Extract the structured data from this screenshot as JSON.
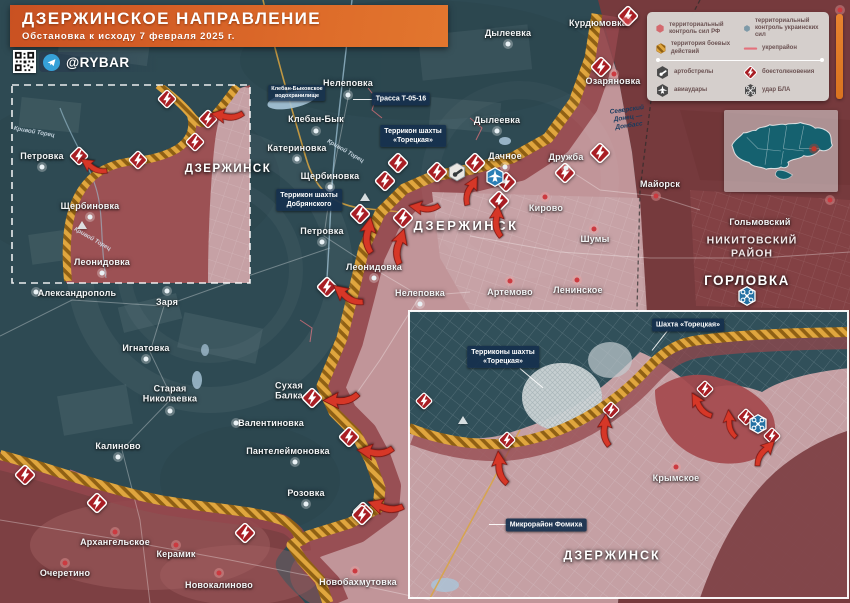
{
  "header": {
    "title": "ДЗЕРЖИНСКОЕ НАПРАВЛЕНИЕ",
    "subtitle": "Обстановка к исходу 7 февраля 2025 г.",
    "channel": "@RYBAR"
  },
  "legend": {
    "items": [
      {
        "icon": "rf-control",
        "label": "территориальный контроль сил РФ"
      },
      {
        "icon": "ukr-control",
        "label": "территориальный контроль украинских сил"
      },
      {
        "icon": "combat-zone",
        "label": "территория боевых действий"
      },
      {
        "icon": "fortified-line",
        "label": "укрепрайон"
      },
      {
        "icon": "artillery",
        "label": "артобстрелы"
      },
      {
        "icon": "clash",
        "label": "боестолкновения"
      },
      {
        "icon": "airstrike",
        "label": "авиаудары"
      },
      {
        "icon": "uav-strike",
        "label": "удар БЛА"
      }
    ]
  },
  "colors": {
    "rf_control": "#763a3d",
    "ukr_control": "#2e4a53",
    "combat_zone": "#e0a63e",
    "fortified_line": "#e4717b",
    "clash": "#a81e24",
    "banner_accent": "#d96428",
    "ukr_icon_blue": "#2b7fb5"
  },
  "map": {
    "town_labels": [
      {
        "t": "Нелеповка",
        "x": 348,
        "y": 83
      },
      {
        "t": "Клебан-Бык",
        "x": 316,
        "y": 119
      },
      {
        "t": "Катериновка",
        "x": 297,
        "y": 148
      },
      {
        "t": "Щербиновка",
        "x": 330,
        "y": 176
      },
      {
        "t": "Петровка",
        "x": 322,
        "y": 231
      },
      {
        "t": "Леонидовка",
        "x": 374,
        "y": 267
      },
      {
        "t": "Нелеповка",
        "x": 420,
        "y": 293
      },
      {
        "t": "Александрополь",
        "x": 77,
        "y": 293
      },
      {
        "t": "Заря",
        "x": 167,
        "y": 302
      },
      {
        "t": "Игнатовка",
        "x": 146,
        "y": 348
      },
      {
        "t": "Старая\nНиколаевка",
        "x": 170,
        "y": 394
      },
      {
        "t": "Калиново",
        "x": 118,
        "y": 446
      },
      {
        "t": "Сухая\nБалка",
        "x": 289,
        "y": 391
      },
      {
        "t": "Валентиновка",
        "x": 271,
        "y": 423
      },
      {
        "t": "Пантелеймоновка",
        "x": 288,
        "y": 451
      },
      {
        "t": "Розовка",
        "x": 306,
        "y": 493
      },
      {
        "t": "Архангельское",
        "x": 115,
        "y": 542
      },
      {
        "t": "Керамик",
        "x": 176,
        "y": 554
      },
      {
        "t": "Очеретино",
        "x": 65,
        "y": 573
      },
      {
        "t": "Новокалиново",
        "x": 219,
        "y": 585
      },
      {
        "t": "Новобахмутовка",
        "x": 358,
        "y": 582
      },
      {
        "t": "Дылеевка",
        "x": 508,
        "y": 33
      },
      {
        "t": "Курдюмовка",
        "x": 598,
        "y": 23
      },
      {
        "t": "Озаряновка",
        "x": 613,
        "y": 81
      },
      {
        "t": "Дылеевка",
        "x": 497,
        "y": 120
      },
      {
        "t": "Дачное",
        "x": 505,
        "y": 156
      },
      {
        "t": "Дружба",
        "x": 566,
        "y": 157
      },
      {
        "t": "Кирово",
        "x": 546,
        "y": 208
      },
      {
        "t": "Шумы",
        "x": 595,
        "y": 239
      },
      {
        "t": "Артемово",
        "x": 510,
        "y": 292
      },
      {
        "t": "Ленинское",
        "x": 578,
        "y": 290
      },
      {
        "t": "Майорск",
        "x": 660,
        "y": 184
      },
      {
        "t": "Гольмовский",
        "x": 760,
        "y": 222
      },
      {
        "t": "Крымское",
        "x": 676,
        "y": 478
      },
      {
        "t": "Петровка",
        "x": 42,
        "y": 156
      },
      {
        "t": "Щербиновка",
        "x": 90,
        "y": 206
      },
      {
        "t": "Леонидовка",
        "x": 102,
        "y": 262
      }
    ],
    "area_labels": [
      {
        "t": "ДЗЕРЖИНСК",
        "x": 466,
        "y": 226,
        "fs": 13,
        "ls": 2.5
      },
      {
        "t": "ДЗЕРЖИНСК",
        "x": 228,
        "y": 170,
        "fs": 11.5,
        "ls": 1.5
      },
      {
        "t": "ДЗЕРЖИНСК",
        "x": 612,
        "y": 556,
        "fs": 12.5,
        "ls": 2
      },
      {
        "t": "ГОРЛОВКА",
        "x": 747,
        "y": 281,
        "fs": 13.5,
        "ls": 1.5
      },
      {
        "t": "НИКИТОВСКИЙ\nРАЙОН",
        "x": 752,
        "y": 247,
        "fs": 10.5,
        "ls": 1,
        "op": 0.88
      }
    ],
    "callouts": [
      {
        "t": "Трасса Т-05-16",
        "x": 401,
        "y": 99,
        "leader": {
          "x": 353,
          "y": 99,
          "len": 26,
          "ang": 0
        }
      },
      {
        "t": "Террикон шахты\n«Торецкая»",
        "x": 413,
        "y": 136
      },
      {
        "t": "Террикон шахты\nДобрянского",
        "x": 309,
        "y": 200
      },
      {
        "t": "Клебан-Быковское\nводохранилище",
        "x": 297,
        "y": 93,
        "small": true
      },
      {
        "t": "Шахта «Торецкая»",
        "x": 688,
        "y": 325,
        "leader": {
          "x": 652,
          "y": 350,
          "len": 26,
          "ang": -52
        }
      },
      {
        "t": "Терриконы шахты\n«Торецкая»",
        "x": 503,
        "y": 357,
        "leader": {
          "x": 520,
          "y": 368,
          "len": 30,
          "ang": 40
        }
      },
      {
        "t": "Микрорайон Фомиха",
        "x": 546,
        "y": 525,
        "leader": {
          "x": 489,
          "y": 524,
          "len": 20,
          "ang": 0
        }
      }
    ],
    "river_labels": [
      {
        "t": "Кривой Торец",
        "x": 345,
        "y": 152,
        "ang": 30
      },
      {
        "t": "Кривой Торец",
        "x": 92,
        "y": 240,
        "ang": 30
      },
      {
        "t": "Кривой Торец",
        "x": 34,
        "y": 133,
        "ang": 10
      },
      {
        "t": "Северский\nДонец —\nДонбасс",
        "x": 628,
        "y": 118,
        "ang": -8,
        "cls": "canal"
      }
    ],
    "clash_main": [
      [
        601,
        67
      ],
      [
        628,
        16
      ],
      [
        600,
        153
      ],
      [
        565,
        173
      ],
      [
        506,
        182
      ],
      [
        475,
        163
      ],
      [
        499,
        201
      ],
      [
        437,
        172
      ],
      [
        398,
        163
      ],
      [
        385,
        181
      ],
      [
        403,
        218
      ],
      [
        360,
        214
      ],
      [
        327,
        287
      ],
      [
        312,
        398
      ],
      [
        349,
        437
      ],
      [
        363,
        512
      ],
      [
        25,
        475
      ],
      [
        97,
        503
      ],
      [
        245,
        533
      ],
      [
        362,
        515
      ]
    ],
    "clash_tl": [
      [
        167,
        99
      ],
      [
        208,
        119
      ],
      [
        195,
        142
      ],
      [
        79,
        156
      ],
      [
        138,
        160
      ]
    ],
    "clash_br": [
      [
        424,
        401
      ],
      [
        507,
        440
      ],
      [
        611,
        410
      ],
      [
        705,
        389
      ],
      [
        746,
        417
      ],
      [
        772,
        436
      ]
    ],
    "artillery_icons": [
      [
        457,
        172
      ]
    ],
    "air_strike_icons": [
      [
        495,
        177
      ]
    ],
    "uav_icons": [
      [
        747,
        296
      ],
      [
        758,
        424
      ]
    ],
    "arrows": [
      [
        227,
        116,
        190,
        0.9
      ],
      [
        93,
        167,
        215,
        0.8
      ],
      [
        368,
        235,
        -80,
        1
      ],
      [
        399,
        246,
        -72,
        1
      ],
      [
        347,
        296,
        -140,
        0.95
      ],
      [
        470,
        190,
        -60,
        0.85
      ],
      [
        497,
        221,
        -85,
        0.9
      ],
      [
        424,
        208,
        -170,
        0.85
      ],
      [
        341,
        400,
        180,
        1
      ],
      [
        375,
        452,
        188,
        1
      ],
      [
        385,
        507,
        198,
        1
      ],
      [
        500,
        468,
        -95,
        0.95
      ],
      [
        605,
        430,
        -85,
        0.9
      ],
      [
        700,
        406,
        -120,
        0.85
      ],
      [
        730,
        424,
        -95,
        0.8
      ],
      [
        764,
        452,
        -45,
        0.85
      ]
    ],
    "dots_red": [
      [
        627,
        21
      ],
      [
        614,
        74
      ],
      [
        545,
        197
      ],
      [
        594,
        229
      ],
      [
        510,
        281
      ],
      [
        577,
        280
      ],
      [
        656,
        196
      ],
      [
        676,
        467
      ],
      [
        115,
        532
      ],
      [
        176,
        545
      ],
      [
        65,
        563
      ],
      [
        219,
        573
      ],
      [
        355,
        571
      ],
      [
        830,
        200
      ],
      [
        840,
        10
      ]
    ],
    "dots_light": [
      [
        348,
        95
      ],
      [
        316,
        131
      ],
      [
        297,
        159
      ],
      [
        330,
        187
      ],
      [
        322,
        242
      ],
      [
        374,
        278
      ],
      [
        420,
        304
      ],
      [
        36,
        292
      ],
      [
        167,
        291
      ],
      [
        146,
        359
      ],
      [
        170,
        411
      ],
      [
        118,
        457
      ],
      [
        236,
        423
      ],
      [
        295,
        462
      ],
      [
        306,
        504
      ],
      [
        508,
        44
      ],
      [
        497,
        131
      ],
      [
        505,
        167
      ],
      [
        566,
        168
      ],
      [
        42,
        167
      ],
      [
        90,
        217
      ],
      [
        102,
        273
      ]
    ],
    "triangles": [
      [
        365,
        197
      ],
      [
        82,
        225
      ],
      [
        463,
        420
      ]
    ]
  }
}
